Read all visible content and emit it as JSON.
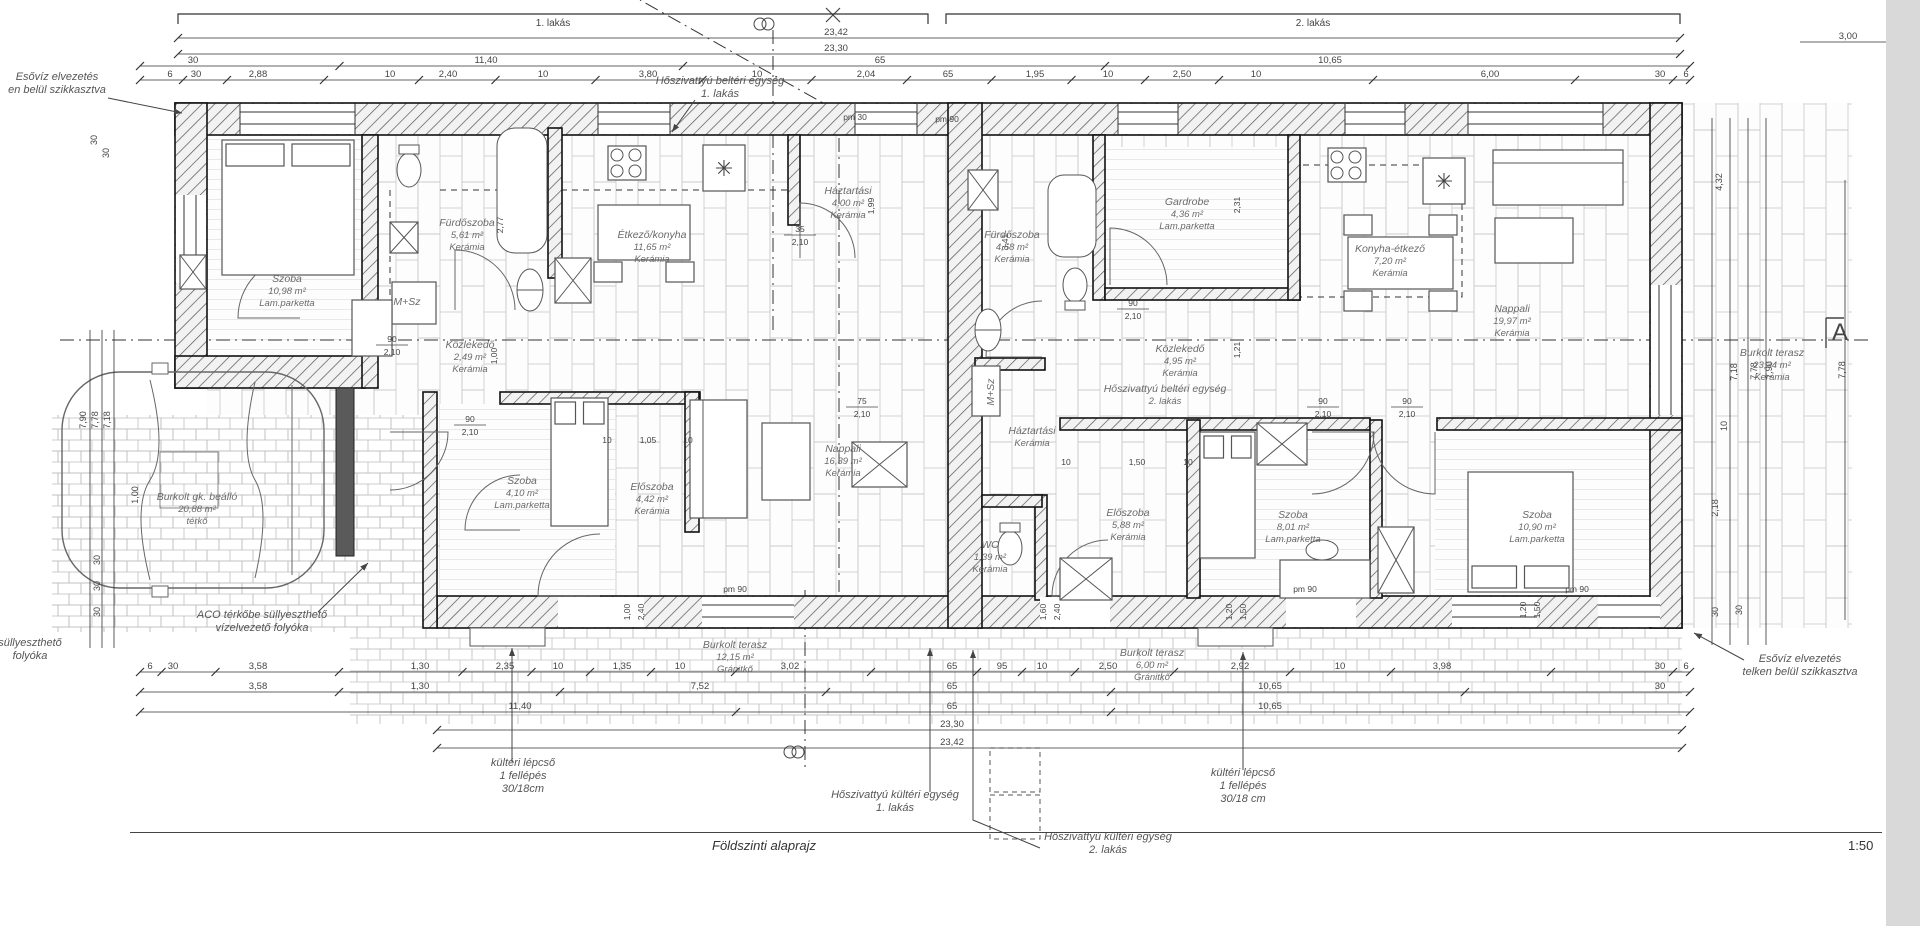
{
  "drawing": {
    "title": "Földszinti alaprajz",
    "scale": "1:50"
  },
  "apartment_bars": [
    {
      "label": "1. lakás",
      "x1": 178,
      "x2": 928,
      "y": 14
    },
    {
      "label": "2. lakás",
      "x1": 946,
      "x2": 1680,
      "y": 14
    }
  ],
  "top_total_dims": [
    {
      "text": "23,42",
      "x": 836,
      "line_y": 38
    },
    {
      "text": "23,30",
      "x": 836,
      "line_y": 54
    }
  ],
  "top_right_dim": {
    "text": "3,00",
    "x": 1848,
    "line_y": 42
  },
  "top_dim_rows": [
    {
      "y": 66,
      "labels": [
        {
          "x": 193,
          "t": "30"
        },
        {
          "x": 486,
          "t": "11,40"
        },
        {
          "x": 880,
          "t": "65"
        },
        {
          "x": 1330,
          "t": "10,65"
        }
      ]
    },
    {
      "y": 80,
      "labels": [
        {
          "x": 170,
          "t": "6"
        },
        {
          "x": 196,
          "t": "30"
        },
        {
          "x": 258,
          "t": "2,88"
        },
        {
          "x": 390,
          "t": "10"
        },
        {
          "x": 448,
          "t": "2,40"
        },
        {
          "x": 543,
          "t": "10"
        },
        {
          "x": 648,
          "t": "3,80"
        },
        {
          "x": 757,
          "t": "10"
        },
        {
          "x": 866,
          "t": "2,04"
        },
        {
          "x": 948,
          "t": "65"
        },
        {
          "x": 1035,
          "t": "1,95"
        },
        {
          "x": 1108,
          "t": "10"
        },
        {
          "x": 1182,
          "t": "2,50"
        },
        {
          "x": 1256,
          "t": "10"
        },
        {
          "x": 1490,
          "t": "6,00"
        },
        {
          "x": 1660,
          "t": "30"
        },
        {
          "x": 1686,
          "t": "6"
        }
      ]
    }
  ],
  "bottom_dim_rows": [
    {
      "y": 672,
      "labels": [
        {
          "x": 150,
          "t": "6"
        },
        {
          "x": 173,
          "t": "30"
        },
        {
          "x": 258,
          "t": "3,58"
        },
        {
          "x": 420,
          "t": "1,30"
        },
        {
          "x": 505,
          "t": "2,35"
        },
        {
          "x": 558,
          "t": "10"
        },
        {
          "x": 622,
          "t": "1,35"
        },
        {
          "x": 680,
          "t": "10"
        },
        {
          "x": 790,
          "t": "3,02"
        },
        {
          "x": 952,
          "t": "65"
        },
        {
          "x": 1002,
          "t": "95"
        },
        {
          "x": 1042,
          "t": "10"
        },
        {
          "x": 1108,
          "t": "2,50"
        },
        {
          "x": 1240,
          "t": "2,92"
        },
        {
          "x": 1340,
          "t": "10"
        },
        {
          "x": 1442,
          "t": "3,98"
        },
        {
          "x": 1660,
          "t": "30"
        },
        {
          "x": 1686,
          "t": "6"
        }
      ]
    },
    {
      "y": 692,
      "labels": [
        {
          "x": 258,
          "t": "3,58"
        },
        {
          "x": 420,
          "t": "1,30"
        },
        {
          "x": 700,
          "t": "7,52"
        },
        {
          "x": 952,
          "t": "65"
        },
        {
          "x": 1270,
          "t": "10,65"
        },
        {
          "x": 1660,
          "t": "30"
        }
      ]
    },
    {
      "y": 712,
      "labels": [
        {
          "x": 520,
          "t": "11,40"
        },
        {
          "x": 952,
          "t": "65"
        },
        {
          "x": 1270,
          "t": "10,65"
        }
      ]
    }
  ],
  "bottom_total_dims": [
    {
      "text": "23,30",
      "x": 952,
      "line_y": 730
    },
    {
      "text": "23,42",
      "x": 952,
      "line_y": 748
    }
  ],
  "left_dims": [
    {
      "x": 86,
      "y": 420,
      "t": "7,90"
    },
    {
      "x": 98,
      "y": 420,
      "t": "7,78"
    },
    {
      "x": 110,
      "y": 420,
      "t": "7,18"
    },
    {
      "x": 100,
      "y": 560,
      "t": "30"
    },
    {
      "x": 100,
      "y": 586,
      "t": "30"
    },
    {
      "x": 100,
      "y": 612,
      "t": "30"
    },
    {
      "x": 138,
      "y": 495,
      "t": "1,00"
    },
    {
      "x": 97,
      "y": 140,
      "t": "30"
    },
    {
      "x": 109,
      "y": 153,
      "t": "30"
    }
  ],
  "right_dims": [
    {
      "x": 1722,
      "y": 182,
      "t": "4,32"
    },
    {
      "x": 1737,
      "y": 372,
      "t": "7,18"
    },
    {
      "x": 1757,
      "y": 371,
      "t": "7,78"
    },
    {
      "x": 1772,
      "y": 370,
      "t": "7,90"
    },
    {
      "x": 1845,
      "y": 370,
      "t": "7,78"
    },
    {
      "x": 1727,
      "y": 426,
      "t": "10"
    },
    {
      "x": 1718,
      "y": 508,
      "t": "2,18"
    },
    {
      "x": 1718,
      "y": 612,
      "t": "30"
    },
    {
      "x": 1742,
      "y": 610,
      "t": "30"
    }
  ],
  "rooms": [
    {
      "id": "szoba-1-1",
      "lines": [
        "Szoba",
        "10,98 m²",
        "Lam.parketta"
      ],
      "x": 287,
      "y": 282
    },
    {
      "id": "furdoszoba-1",
      "lines": [
        "Fürdőszoba",
        "5,61 m²",
        "Kerámia"
      ],
      "x": 467,
      "y": 226
    },
    {
      "id": "etkezo-konyha-1",
      "lines": [
        "Étkező/konyha",
        "11,65 m²",
        "Kerámia"
      ],
      "x": 652,
      "y": 238
    },
    {
      "id": "haztartasi-1",
      "lines": [
        "Háztartási",
        "4,00 m²",
        "Kerámia"
      ],
      "x": 848,
      "y": 194
    },
    {
      "id": "kozlekedo-1",
      "lines": [
        "Közlekedő",
        "2,49 m²",
        "Kerámia"
      ],
      "x": 470,
      "y": 348
    },
    {
      "id": "szoba-1-2",
      "lines": [
        "Szoba",
        "4,10 m²",
        "Lam.parketta"
      ],
      "x": 522,
      "y": 484
    },
    {
      "id": "eloszoba-1",
      "lines": [
        "Előszoba",
        "4,42 m²",
        "Kerámia"
      ],
      "x": 652,
      "y": 490
    },
    {
      "id": "nappali-1",
      "lines": [
        "Nappali",
        "16,39 m²",
        "Kerámia"
      ],
      "x": 843,
      "y": 452
    },
    {
      "id": "msz-1",
      "lines": [
        "M+Sz"
      ],
      "x": 407,
      "y": 305
    },
    {
      "id": "furdoszoba-2",
      "lines": [
        "Fürdőszoba",
        "4,58 m²",
        "Kerámia"
      ],
      "x": 1012,
      "y": 238
    },
    {
      "id": "gardrobe-2",
      "lines": [
        "Gardrobe",
        "4,36 m²",
        "Lam.parketta"
      ],
      "x": 1187,
      "y": 205
    },
    {
      "id": "konyha-etkezo-2",
      "lines": [
        "Konyha-étkező",
        "7,20 m²",
        "Kerámia"
      ],
      "x": 1390,
      "y": 252
    },
    {
      "id": "nappali-2",
      "lines": [
        "Nappali",
        "19,97 m²",
        "Kerámia"
      ],
      "x": 1512,
      "y": 312
    },
    {
      "id": "kozlekedo-2",
      "lines": [
        "Közlekedő",
        "4,95 m²",
        "Kerámia"
      ],
      "x": 1180,
      "y": 352
    },
    {
      "id": "hoszivattyu-belteri-2",
      "lines": [
        "Hőszivattyú beltéri egység",
        "2. lakás"
      ],
      "x": 1165,
      "y": 392
    },
    {
      "id": "msz-2",
      "lines": [
        "M+Sz"
      ],
      "x": 994,
      "y": 392,
      "rot": -90
    },
    {
      "id": "haztartasi-2",
      "lines": [
        "Háztartási",
        "Kerámia"
      ],
      "x": 1032,
      "y": 434
    },
    {
      "id": "wc-2",
      "lines": [
        "WC",
        "1,39 m²",
        "Kerámia"
      ],
      "x": 990,
      "y": 548
    },
    {
      "id": "szoba-2-1",
      "lines": [
        "Szoba",
        "8,01 m²",
        "Lam.parketta"
      ],
      "x": 1293,
      "y": 518
    },
    {
      "id": "szoba-2-2",
      "lines": [
        "Szoba",
        "10,90 m²",
        "Lam.parketta"
      ],
      "x": 1537,
      "y": 518
    },
    {
      "id": "eloszoba-2",
      "lines": [
        "Előszoba",
        "5,88 m²",
        "Kerámia"
      ],
      "x": 1128,
      "y": 516
    },
    {
      "id": "gk-beallo",
      "lines": [
        "Burkolt gk. beálló",
        "20,88 m²",
        "térkő"
      ],
      "x": 197,
      "y": 500
    },
    {
      "id": "terasz-12",
      "lines": [
        "Burkolt terasz",
        "12,15 m²",
        "Gránitkő"
      ],
      "x": 735,
      "y": 648
    },
    {
      "id": "terasz-6",
      "lines": [
        "Burkolt terasz",
        "6,00 m²",
        "Gránitkő"
      ],
      "x": 1152,
      "y": 656
    },
    {
      "id": "terasz-23",
      "lines": [
        "Burkolt terasz",
        "23,34 m²",
        "Kerámia"
      ],
      "x": 1772,
      "y": 356
    }
  ],
  "annotations": [
    {
      "id": "esoviz-left",
      "lines": [
        "Esővíz elvezetés",
        "en belül szikkasztva"
      ],
      "x": 57,
      "y": 80,
      "arrow": [
        108,
        98,
        182,
        113
      ]
    },
    {
      "id": "hoszivattyu-belteri-1",
      "lines": [
        "Hőszivattyú beltéri egység",
        "1. lakás"
      ],
      "x": 720,
      "y": 84,
      "arrow": [
        695,
        100,
        672,
        132
      ]
    },
    {
      "id": "aco-folyoka",
      "lines": [
        "ACO térkőbe süllyeszthető",
        "vízelvezető folyóka"
      ],
      "x": 262,
      "y": 618,
      "arrow": [
        318,
        612,
        368,
        563
      ]
    },
    {
      "id": "folyoka-left",
      "lines": [
        "süllyeszthető",
        "folyóka"
      ],
      "x": 30,
      "y": 646
    },
    {
      "id": "lepcso-left",
      "lines": [
        "kültéri lépcső",
        "1 fellépés",
        "30/18cm"
      ],
      "x": 523,
      "y": 766,
      "leader": [
        [
          512,
          762
        ],
        [
          512,
          648
        ]
      ]
    },
    {
      "id": "hoszivattyu-kulteri-1",
      "lines": [
        "Hőszivattyú kültéri egység",
        "1. lakás"
      ],
      "x": 895,
      "y": 798,
      "leader": [
        [
          930,
          792
        ],
        [
          930,
          648
        ]
      ]
    },
    {
      "id": "hoszivattyu-kulteri-2",
      "lines": [
        "Hőszivattyú kültéri egység",
        "2. lakás"
      ],
      "x": 1108,
      "y": 840,
      "leader": [
        [
          1040,
          848
        ],
        [
          973,
          820
        ],
        [
          973,
          650
        ]
      ]
    },
    {
      "id": "lepcso-right",
      "lines": [
        "kültéri lépcső",
        "1 fellépés",
        "30/18 cm"
      ],
      "x": 1243,
      "y": 776,
      "leader": [
        [
          1243,
          770
        ],
        [
          1243,
          652
        ]
      ]
    },
    {
      "id": "esoviz-right",
      "lines": [
        "Esővíz elvezetés",
        "telken belül szikkasztva"
      ],
      "x": 1800,
      "y": 662,
      "arrow": [
        1744,
        660,
        1694,
        633
      ]
    }
  ],
  "inline_fracs": [
    {
      "x": 392,
      "y": 342,
      "top": "90",
      "bot": "2,10"
    },
    {
      "x": 470,
      "y": 422,
      "top": "90",
      "bot": "2,10"
    },
    {
      "x": 800,
      "y": 232,
      "top": "35",
      "bot": "2,10"
    },
    {
      "x": 862,
      "y": 404,
      "top": "75",
      "bot": "2,10"
    },
    {
      "x": 1133,
      "y": 306,
      "top": "90",
      "bot": "2,10"
    },
    {
      "x": 1323,
      "y": 404,
      "top": "90",
      "bot": "2,10"
    },
    {
      "x": 1407,
      "y": 404,
      "top": "90",
      "bot": "2,10"
    }
  ],
  "small_dims": [
    {
      "x": 735,
      "y": 592,
      "t": "pm 90"
    },
    {
      "x": 1305,
      "y": 592,
      "t": "pm 90"
    },
    {
      "x": 1577,
      "y": 592,
      "t": "pm 90"
    },
    {
      "x": 947,
      "y": 122,
      "t": "pm 90"
    },
    {
      "x": 855,
      "y": 120,
      "t": "pm 30"
    },
    {
      "x": 630,
      "y": 612,
      "t": "1,00",
      "rot": -90
    },
    {
      "x": 644,
      "y": 612,
      "t": "2,40",
      "rot": -90
    },
    {
      "x": 1046,
      "y": 612,
      "t": "1,60",
      "rot": -90
    },
    {
      "x": 1060,
      "y": 612,
      "t": "2,40",
      "rot": -90
    },
    {
      "x": 1232,
      "y": 612,
      "t": "1,20",
      "rot": -90
    },
    {
      "x": 1246,
      "y": 612,
      "t": "1,50",
      "rot": -90
    },
    {
      "x": 1526,
      "y": 610,
      "t": "1,20",
      "rot": -90
    },
    {
      "x": 1540,
      "y": 610,
      "t": "1,50",
      "rot": -90
    },
    {
      "x": 874,
      "y": 206,
      "t": "1,99",
      "rot": -90
    },
    {
      "x": 1240,
      "y": 205,
      "t": "2,31",
      "rot": -90
    },
    {
      "x": 1240,
      "y": 350,
      "t": "1,21",
      "rot": -90
    },
    {
      "x": 1008,
      "y": 242,
      "t": "3,41",
      "rot": -90
    },
    {
      "x": 503,
      "y": 225,
      "t": "2,77",
      "rot": -90
    },
    {
      "x": 497,
      "y": 356,
      "t": "1,00",
      "rot": -90
    },
    {
      "x": 607,
      "y": 443,
      "t": "10"
    },
    {
      "x": 648,
      "y": 443,
      "t": "1,05"
    },
    {
      "x": 688,
      "y": 443,
      "t": "10"
    },
    {
      "x": 1066,
      "y": 465,
      "t": "10"
    },
    {
      "x": 1137,
      "y": 465,
      "t": "1,50"
    },
    {
      "x": 1188,
      "y": 465,
      "t": "10"
    }
  ],
  "markers": {
    "section_a": {
      "t": "A",
      "x": 1840,
      "y": 340
    }
  }
}
